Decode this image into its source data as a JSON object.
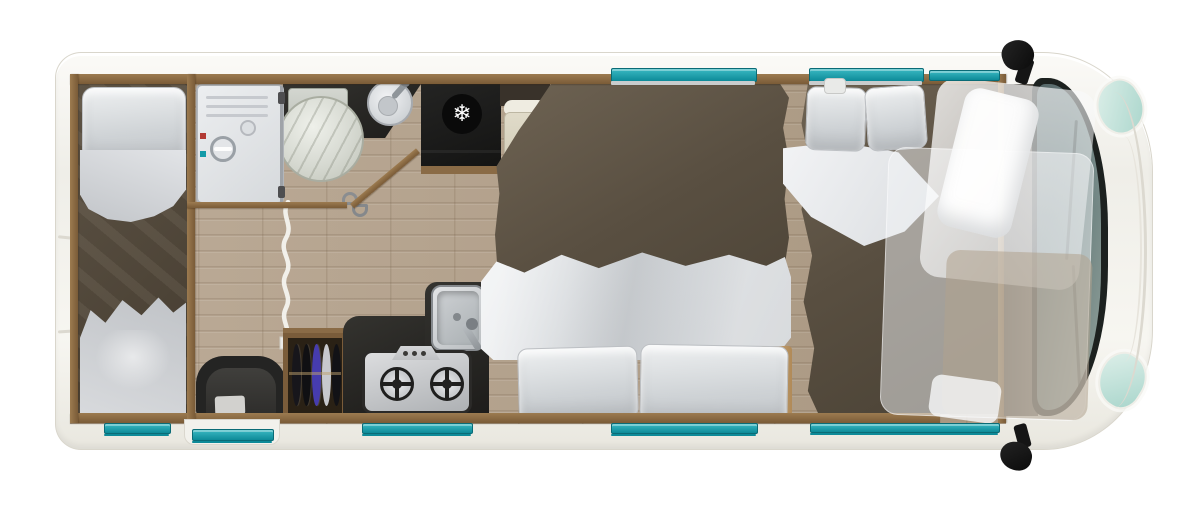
{
  "floorplan": {
    "subject": "motorhome-top-view-floorplan",
    "icons": {
      "fridge_snowflake": "❄"
    },
    "colors": {
      "teal": "#0d8a98",
      "teal_bright": "#14a0ae",
      "body_white": "#f7f6f1",
      "body_edge": "#d9d6cc",
      "wall_wood": "#8a6b46",
      "floor_wood": "#b5a491",
      "counter_black": "#1d1c1a",
      "duvet_brown": "#594f41",
      "bedding_grey": "#d4d6d9",
      "bedding_white": "#eceef0",
      "wardrobe_wood": "#7a5c3a",
      "glass_dark": "#33484a",
      "headlight_teal": "#bfe2da",
      "step_tan": "#c4a171"
    },
    "features": [
      "rear-twin-single-beds",
      "shower-cubicle",
      "toilet",
      "washbasin",
      "privacy-curtain",
      "wardrobe-hanging-clothes",
      "lounge-chair",
      "kitchen-sink",
      "two-burner-hob",
      "fridge",
      "travel-seat",
      "transverse-double-bed",
      "front-double-bed",
      "drop-down-overcab-bed",
      "cab-windscreen",
      "wing-mirrors",
      "entrance-door",
      "windows"
    ]
  }
}
